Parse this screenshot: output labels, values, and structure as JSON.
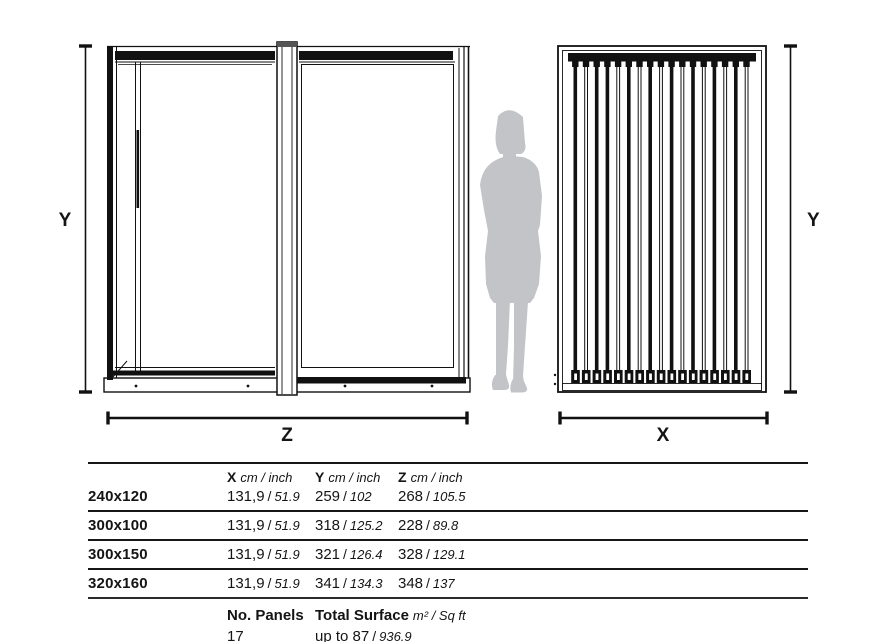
{
  "drawing": {
    "line_color": "#171717",
    "silhouette_color": "#c2c4c8",
    "labels": {
      "y_left": "Y",
      "z": "Z",
      "x": "X",
      "y_right": "Y"
    }
  },
  "table": {
    "sep": "/",
    "header": {
      "x_label": "X",
      "x_unit": "cm / inch",
      "y_label": "Y",
      "y_unit": "cm / inch",
      "z_label": "Z",
      "z_unit": "cm / inch"
    },
    "rows": [
      {
        "size": "240x120",
        "values": [
          {
            "cm": "131,9",
            "inch": "51.9"
          },
          {
            "cm": "259",
            "inch": "102"
          },
          {
            "cm": "268",
            "inch": "105.5"
          }
        ]
      },
      {
        "size": "300x100",
        "values": [
          {
            "cm": "131,9",
            "inch": "51.9"
          },
          {
            "cm": "318",
            "inch": "125.2"
          },
          {
            "cm": "228",
            "inch": "89.8"
          }
        ]
      },
      {
        "size": "300x150",
        "values": [
          {
            "cm": "131,9",
            "inch": "51.9"
          },
          {
            "cm": "321",
            "inch": "126.4"
          },
          {
            "cm": "328",
            "inch": "129.1"
          }
        ]
      },
      {
        "size": "320x160",
        "values": [
          {
            "cm": "131,9",
            "inch": "51.9"
          },
          {
            "cm": "341",
            "inch": "134.3"
          },
          {
            "cm": "348",
            "inch": "137"
          }
        ]
      }
    ],
    "footer": {
      "panels_label": "No. Panels",
      "panels_value": "17",
      "surface_label": "Total Surface",
      "surface_unit": "m² / Sq ft",
      "surface_value_main": "up to 87",
      "surface_value_inch": "936.9"
    }
  }
}
